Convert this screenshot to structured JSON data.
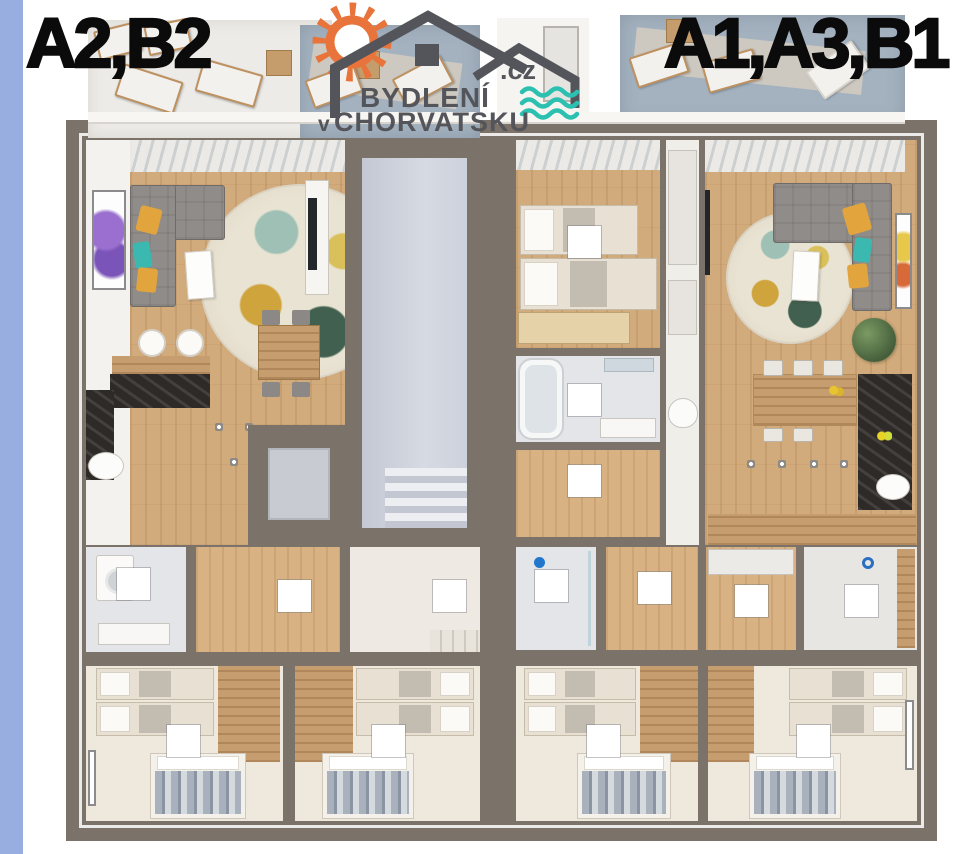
{
  "header": {
    "left_unit_label": "A2,B2",
    "right_unit_label": "A1,A3,B1"
  },
  "logo": {
    "title": "BYDLENÍ",
    "subtitle_prefix": "v",
    "subtitle": "CHORVATSKU",
    "domain": ".cz"
  },
  "colors": {
    "strip": "#98ade0",
    "wall": "#7b7269",
    "wood": "#d2ab7c",
    "hallwood": "#d9b284",
    "woodstrip": "#c69d6e",
    "bedfloor": "#efe8dd",
    "bathfloor": "#e3e5e8",
    "stairfloor": "#ccd1db",
    "entryfloor": "#eee9e2",
    "terrace": "#a4b2c0",
    "sofa": "#8f8c89",
    "pillow_y": "#e2a43c",
    "pillow_t": "#3bb8b0",
    "rug": "#e9e3d3",
    "marble": "#2e2a28",
    "label": "#ffffff",
    "title": "#0b0b0b",
    "logogray": "#54555a",
    "logoorange": "#e8743b",
    "logoteal": "#2cc0b0"
  }
}
